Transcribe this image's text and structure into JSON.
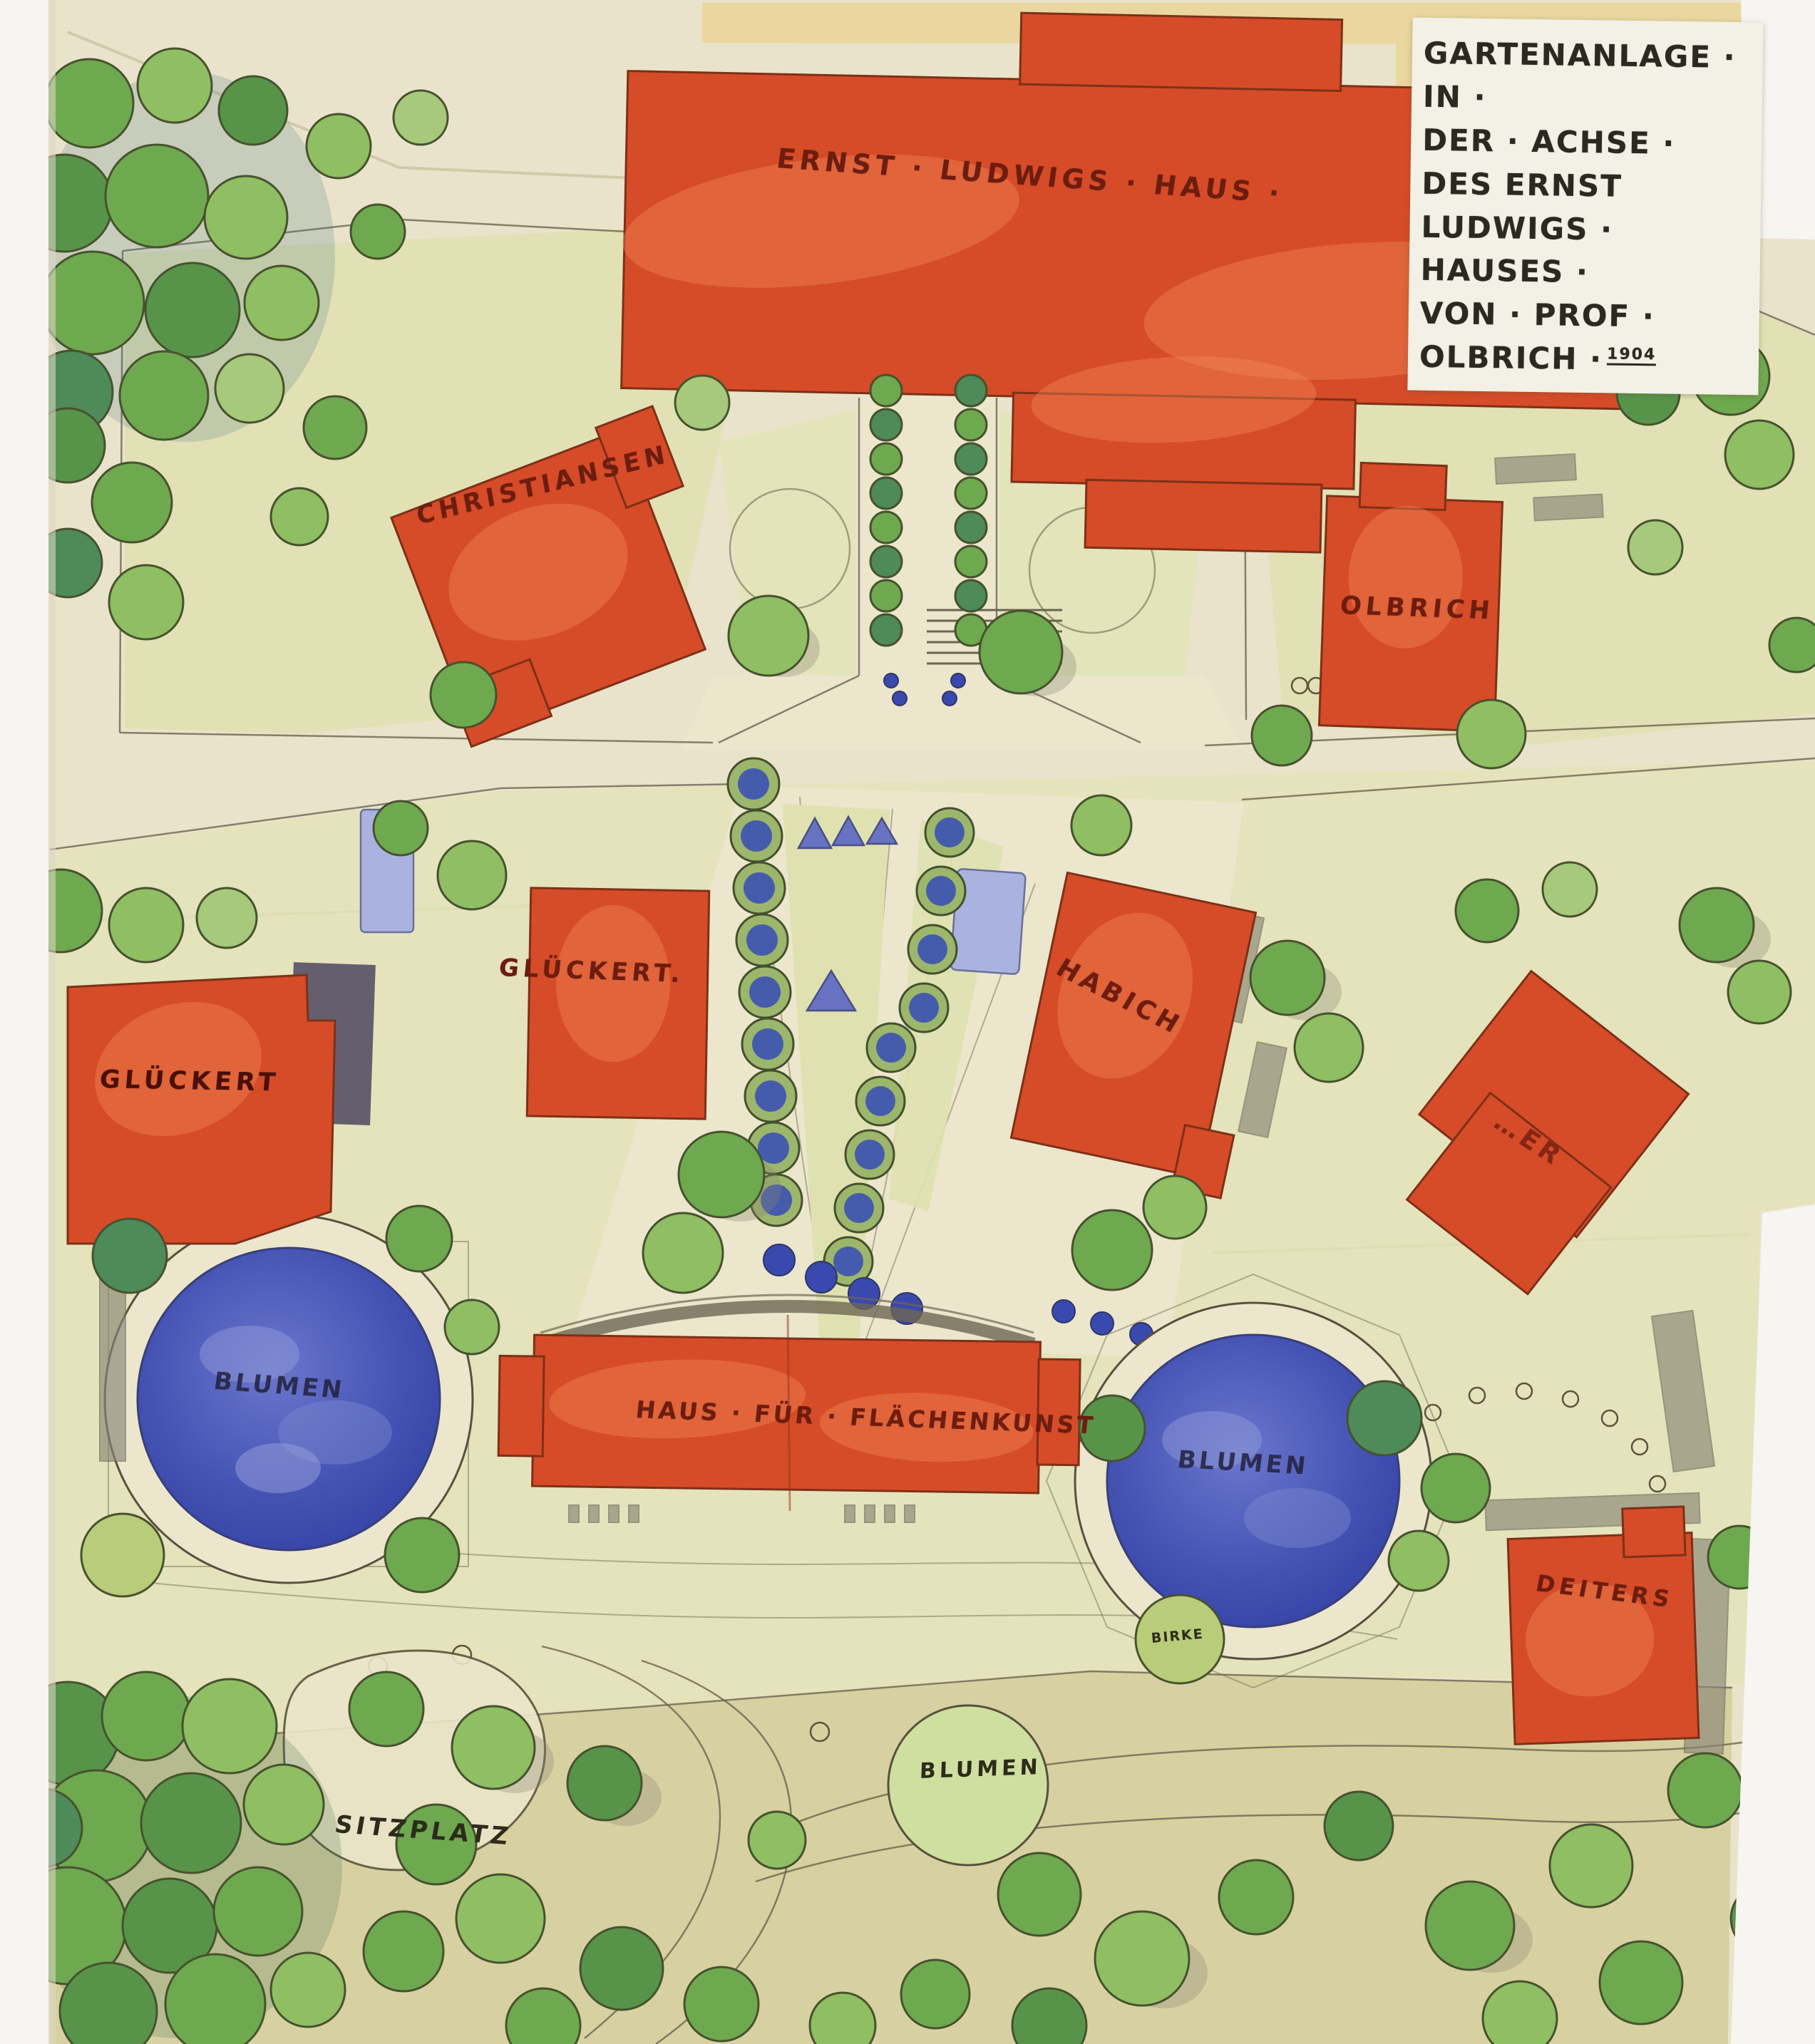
{
  "title_block": {
    "lines": [
      "GARTENANLAGE · IN ·",
      "DER · ACHSE · DES ERNST",
      "LUDWIGS · HAUSES ·",
      "VON · PROF · OLBRICH ·"
    ],
    "year": "1904"
  },
  "labels": {
    "ernst_ludwigs_haus": "ERNST · LUDWIGS · HAUS ·",
    "christiansen": "CHRISTIANSEN",
    "olbrich": "OLBRICH",
    "glueckert_small": "GLÜCKERT.",
    "glueckert_large": "GLÜCKERT",
    "habich": "HABICH",
    "faded_name": "…ER",
    "flaechenkunst": "HAUS · FÜR · FLÄCHENKUNST",
    "deiters": "DEITERS",
    "blumen_left": "BLUMEN",
    "blumen_right": "BLUMEN",
    "blumen_bottom": "BLUMEN",
    "sitzplatz": "SITZPLATZ",
    "birke": "BIRKE"
  },
  "colors": {
    "paper": "#eae3cb",
    "paper_top_band": "#e9d79f",
    "label_paper": "#f3f0e5",
    "building_red": "#d64c28",
    "lawn_green": "#dfe0b2",
    "flower_blue": "#3f4cb2",
    "ink": "#3f3a2c",
    "building_label_ink": "#6d1d0f"
  }
}
